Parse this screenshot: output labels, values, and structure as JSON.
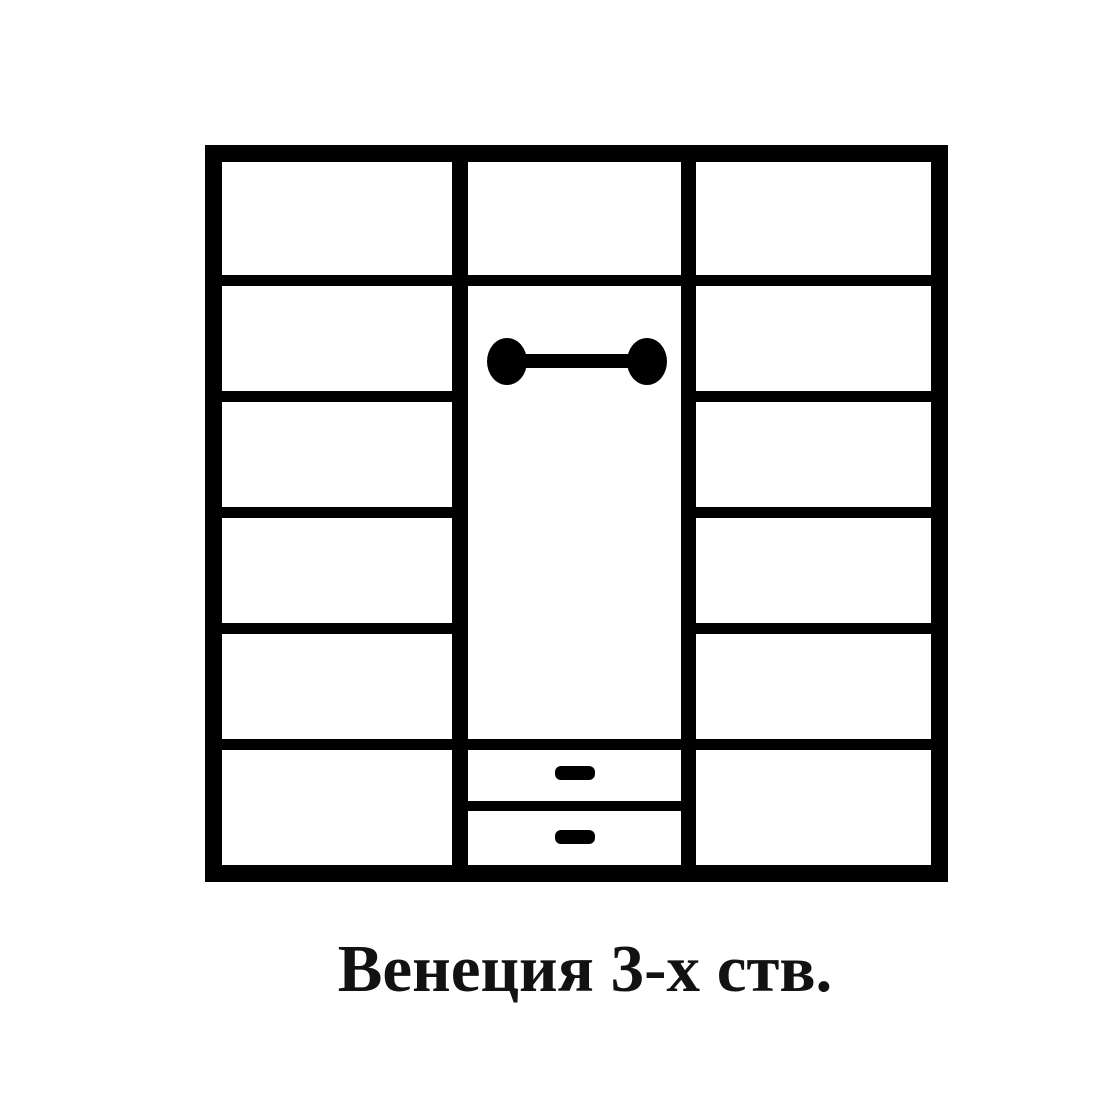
{
  "diagram": {
    "kind": "wardrobe-front-schematic",
    "caption": "Венеция 3-х ств.",
    "colors": {
      "line": "#000000",
      "background": "#ffffff",
      "text": "#121212"
    },
    "sections": [
      {
        "id": "left",
        "type": "shelving",
        "compartments": 6,
        "shelves": 5
      },
      {
        "id": "middle",
        "type": "hanging",
        "top_compartments": 1,
        "hanging_rod": true,
        "drawers": 2
      },
      {
        "id": "right",
        "type": "shelving",
        "compartments": 6,
        "shelves": 5
      }
    ]
  }
}
